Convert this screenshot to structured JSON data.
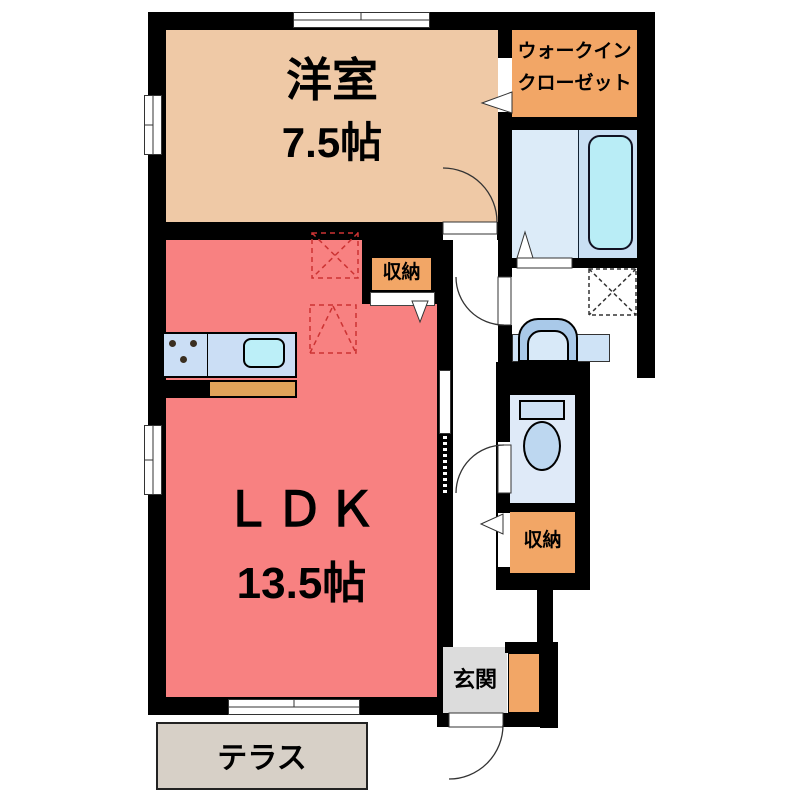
{
  "floorplan": {
    "rooms": {
      "western": {
        "name": "洋室",
        "size": "7.5帖"
      },
      "walk_in_closet": {
        "line1": "ウォークイン",
        "line2": "クローゼット"
      },
      "ldk": {
        "name": "ＬＤＫ",
        "size": "13.5帖"
      },
      "storage_ldk": {
        "label": "収納"
      },
      "storage_hall": {
        "label": "収納"
      },
      "entrance": {
        "label": "玄関"
      },
      "terrace": {
        "label": "テラス"
      }
    },
    "colors": {
      "wall": "#000000",
      "western_room": "#efc9a6",
      "closet_orange": "#f2a666",
      "ldk_salmon": "#f88181",
      "bath_floor": "#dcebf8",
      "bath_tub_zone": "#c9dff3",
      "bathtub": "#b9edf6",
      "fixture_blue": "#cfe2f6",
      "counter_blue": "#cbdef5",
      "sink_cyan": "#bceff8",
      "counter_front_orange": "#e0a35a",
      "entrance_gray": "#dcdcdc",
      "terrace_beige": "#d7d0c7",
      "dashed_marker_red": "#cc3333"
    }
  }
}
